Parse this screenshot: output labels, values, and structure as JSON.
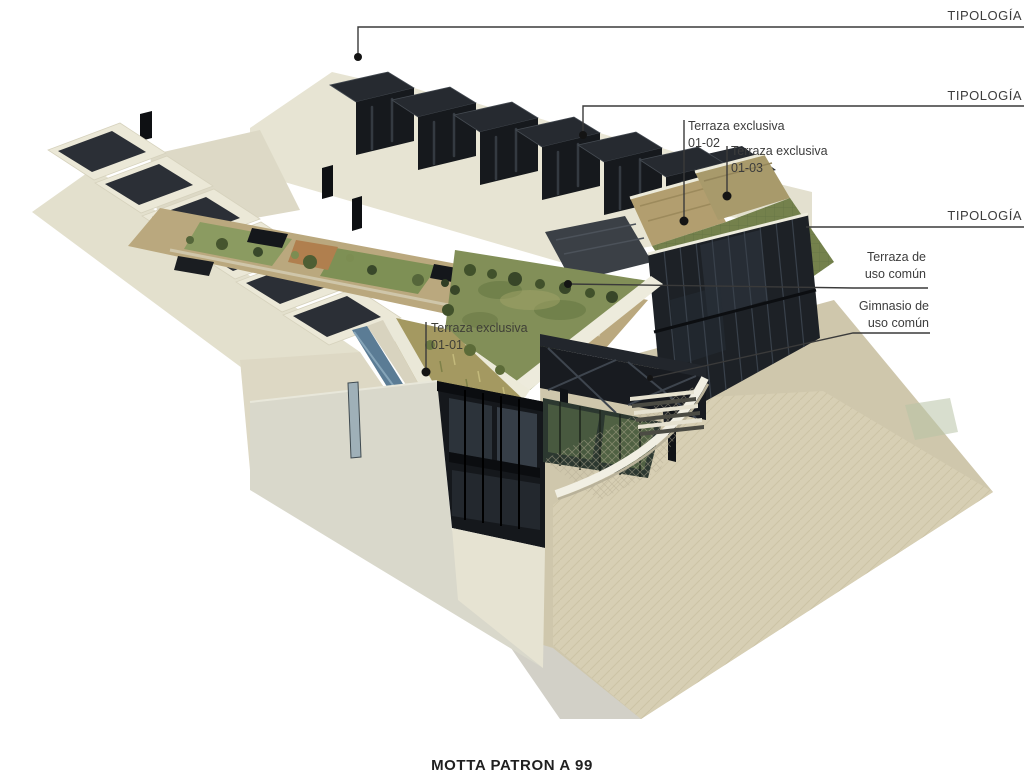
{
  "diagram": {
    "type": "architectural-axonometric-render",
    "callouts": {
      "tipologia_top": "TIPOLOGÍA",
      "tipologia_mid": "TIPOLOGÍA",
      "tipologia_low": "TIPOLOGÍA",
      "terraza_01_02": {
        "title": "Terraza exclusiva",
        "unit": "01-02"
      },
      "terraza_01_03": {
        "title": "Terraza exclusiva",
        "unit": "01-03"
      },
      "terraza_01_01": {
        "title": "Terraza exclusiva",
        "unit": "01-01"
      },
      "terraza_comun": {
        "line1": "Terraza de",
        "line2": "uso común"
      },
      "gimnasio_comun": {
        "line1": "Gimnasio de",
        "line2": "uso común"
      }
    },
    "caption": "MOTTA PATRON A 99",
    "colors": {
      "background": "#ffffff",
      "leader_line": "#3a3a3a",
      "label_text": "#3c3c3c",
      "cream_wall": "#e8e5d4",
      "shaded_wall": "#d9d8cb",
      "dark_roof_panel": "#2b2f36",
      "dark_glass": "#1d2126",
      "green_roof": "#828f58",
      "dry_grass_terrace": "#a49961",
      "tan_terrace": "#b29e6f",
      "plaza_paving": "#d7cfb4",
      "water_channel": "#5b7c95",
      "gym_glass_green": "#4d5f42"
    }
  }
}
